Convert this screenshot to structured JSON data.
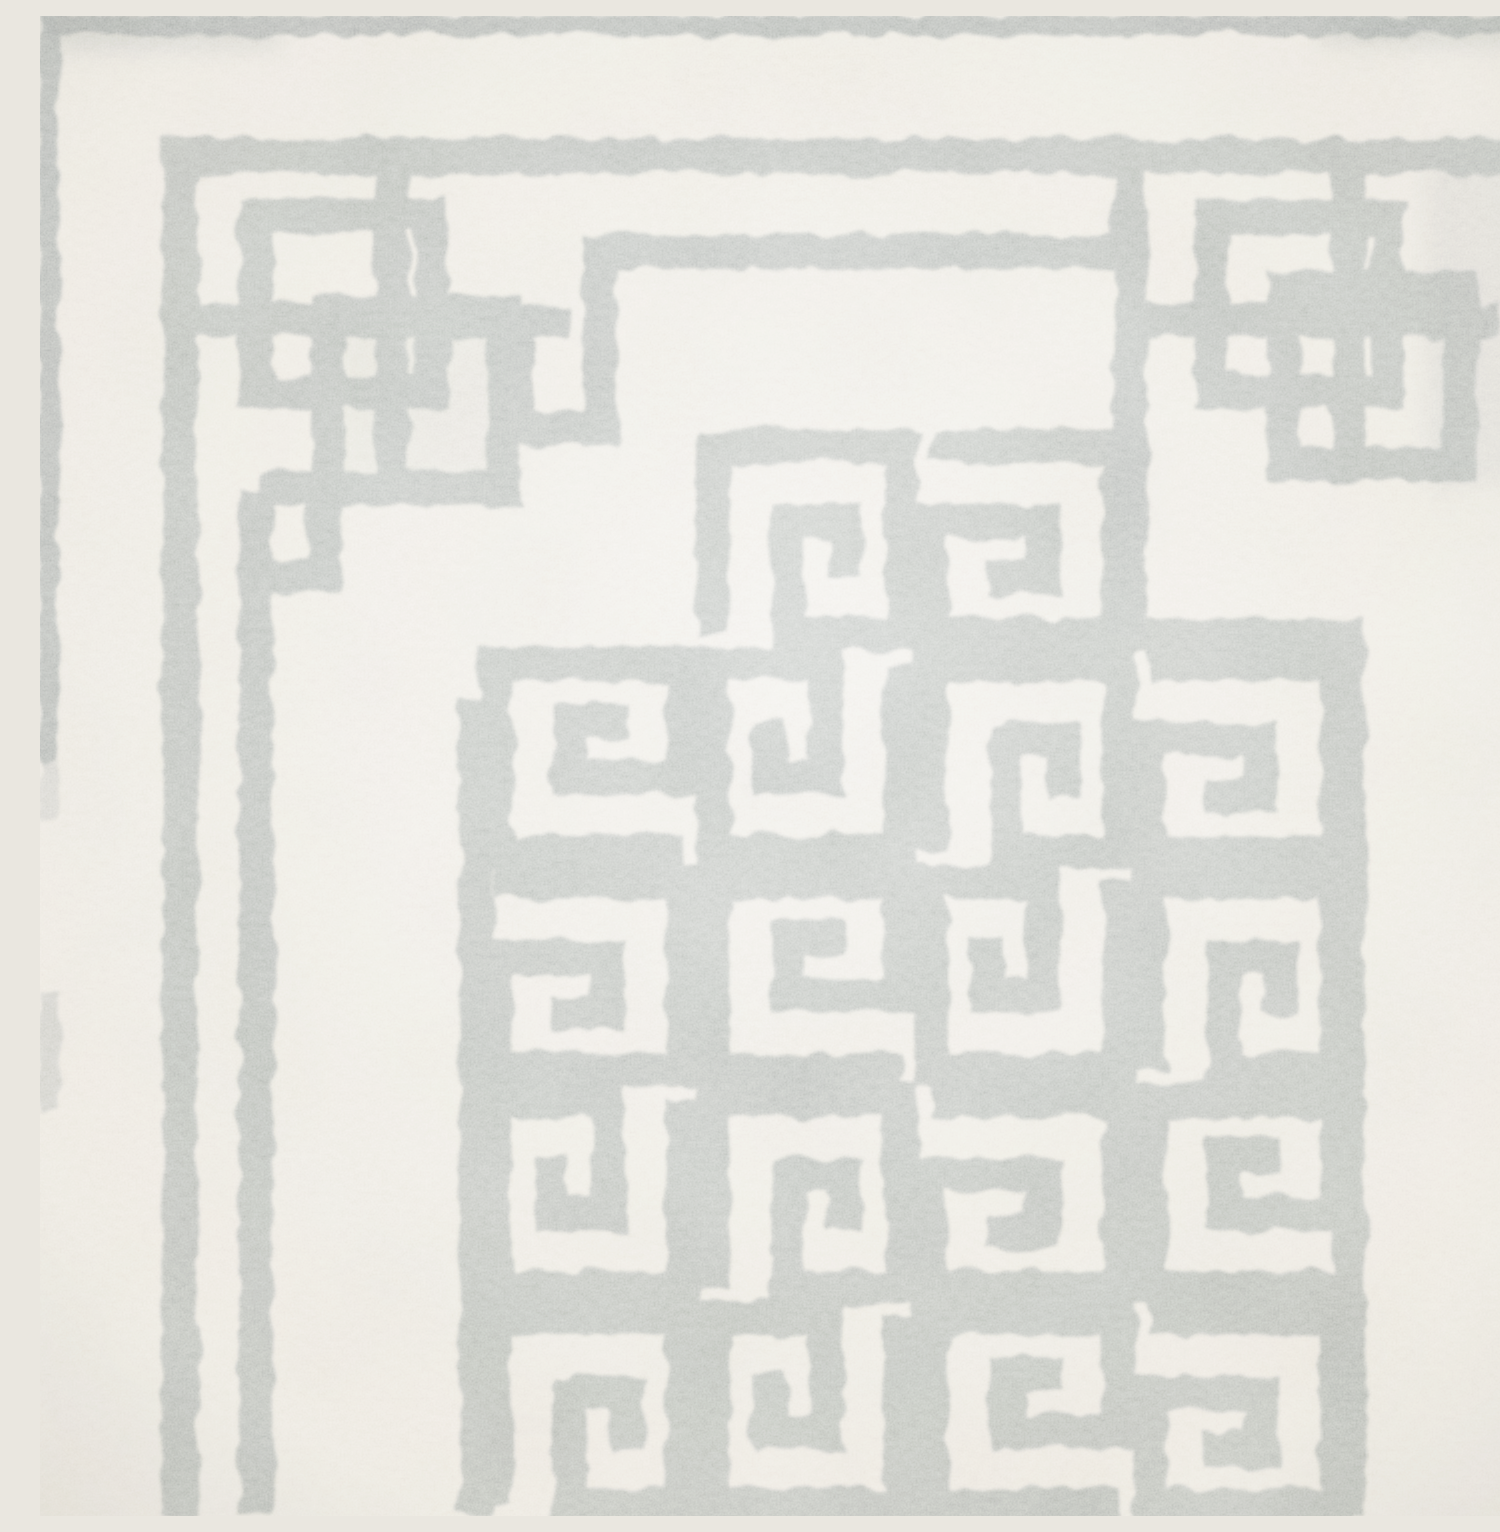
{
  "image": {
    "subject": "Close-up photograph of a hand-tufted wool area rug with a gray Greek key fret pattern on an ivory field",
    "medium": "looped wool pile rug, overhead detail crop",
    "texture": "boucle wool loops, soft hand-hooked yarn edges"
  },
  "colors": {
    "field_ivory": "#ebe8e1",
    "field_highlight": "#f4f1ea",
    "field_shadow": "#d9d5cb",
    "pattern_gray": "#b1b6b2",
    "pattern_gray_dark": "#9aa19e",
    "edge_band_gray": "#a4aaa8"
  },
  "pattern": {
    "style": "Greek key / Chinese fret lattice",
    "motifs": [
      "top edge binding band",
      "left edge binding band",
      "outer L-shaped border line",
      "inner parallel border line with key hooks",
      "interlaced lattice corner knot (top-left)",
      "interlaced lattice corner knot (top-right)",
      "stepped medallion of interlocking greek-key spirals"
    ],
    "corner_knot_count": 2,
    "medallion_unit_count": 18
  }
}
